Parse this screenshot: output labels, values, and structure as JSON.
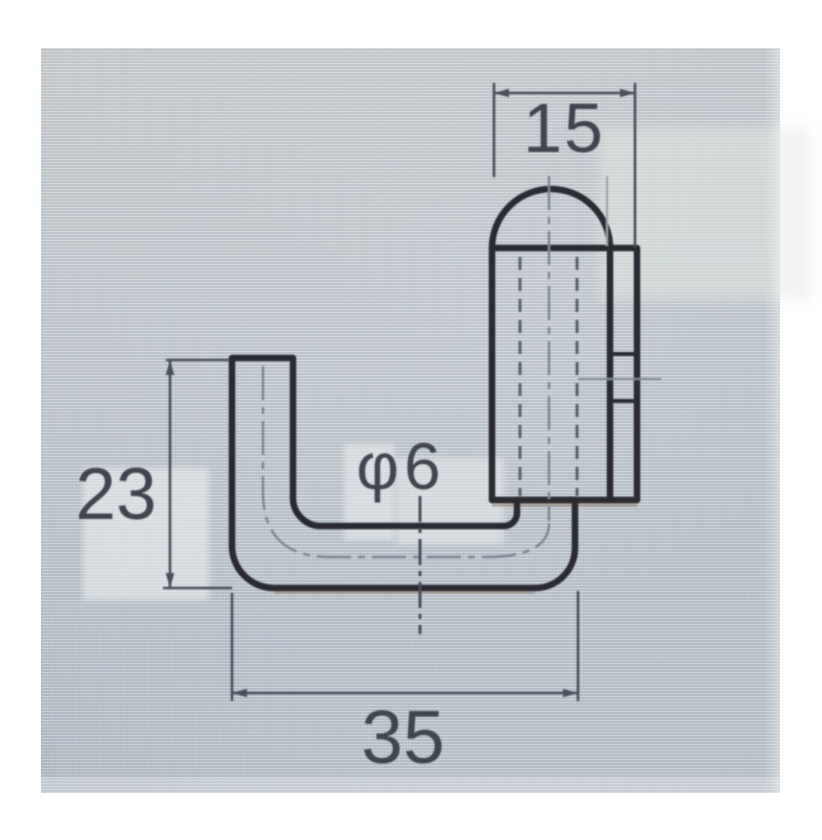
{
  "scene": {
    "description": "Photograph of a monochrome CAD technical drawing shown on a screen: side view of a J-shaped hook bent from round bar with a cylindrical domed head",
    "page_background": "#ffffff",
    "photo_base_color": "#bcc4cb"
  },
  "drawing": {
    "part": "bent-round-bar-hook",
    "dimensions": {
      "head_width": {
        "label": "15",
        "value": 15
      },
      "arm_height": {
        "label": "23",
        "value": 23
      },
      "base_width": {
        "label": "35",
        "value": 35
      },
      "bar_diameter": {
        "label": "φ6",
        "value": 6
      }
    },
    "line_colors": {
      "outline": "#2b2a33",
      "dimension": "#4a4f5b",
      "hidden": "#5a616f",
      "centerline": "#7d8593",
      "faint": "#98a0ab",
      "fringe": "#8a6f58",
      "text": "#3f4450"
    }
  }
}
